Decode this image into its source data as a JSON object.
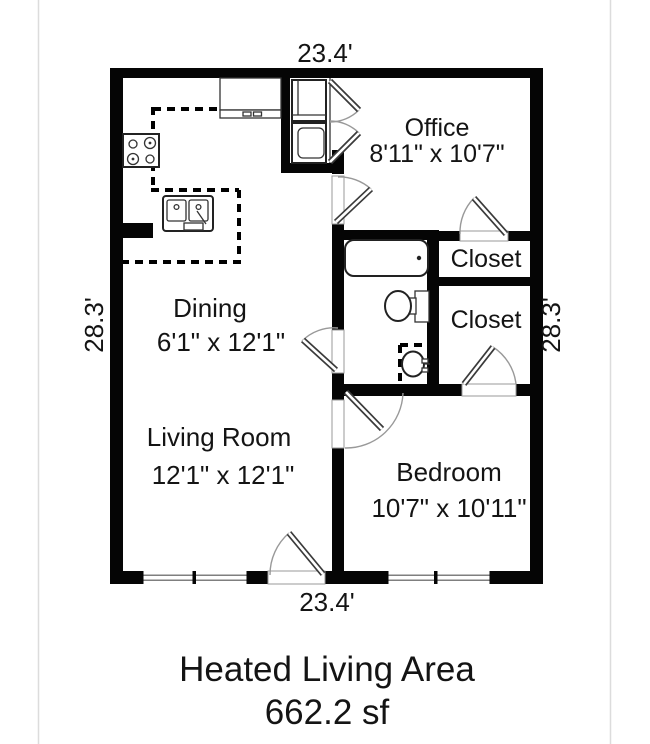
{
  "page": {
    "background": "#ffffff"
  },
  "floor_plan": {
    "exterior_dimensions": {
      "top": "23.4'",
      "bottom": "23.4'",
      "left": "28.3'",
      "right": "28.3'"
    },
    "rooms": {
      "office": {
        "name": "Office",
        "size": "8'11\" x 10'7\""
      },
      "closet_upper": {
        "name": "Closet"
      },
      "closet_lower": {
        "name": "Closet"
      },
      "dining": {
        "name": "Dining",
        "size": "6'1\" x 12'1\""
      },
      "living_room": {
        "name": "Living Room",
        "size": "12'1\" x 12'1\""
      },
      "bedroom": {
        "name": "Bedroom",
        "size": "10'7\" x 10'11\""
      }
    },
    "fixture_icons": [
      "stove-icon",
      "kitchen-sink-icon",
      "kitchen-counter-icon",
      "refrigerator-icon",
      "washer-dryer-icon",
      "bathtub-icon",
      "toilet-icon",
      "pedestal-sink-icon",
      "window-icon",
      "door-swing-icon"
    ],
    "footer": {
      "title": "Heated Living Area",
      "area": "662.2 sf"
    },
    "colors": {
      "wall": "#000000",
      "door_arc": "#999999",
      "fixture_stroke": "#222222",
      "dashed_counter": "#000000"
    }
  }
}
